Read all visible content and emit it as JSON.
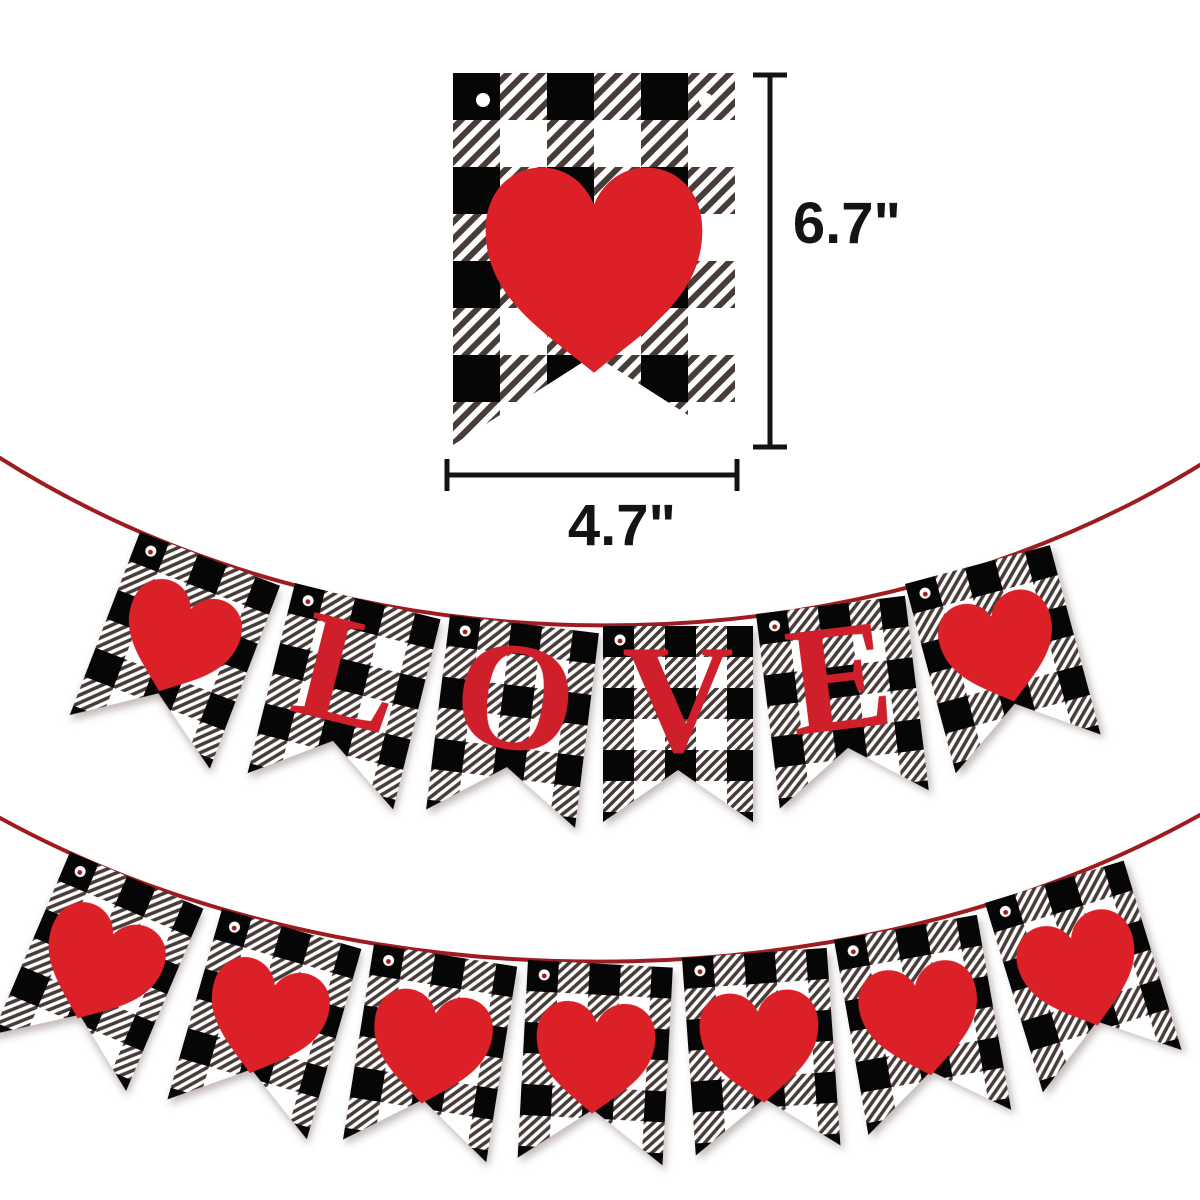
{
  "dimensions": {
    "height_label": "6.7\"",
    "width_label": "4.7\""
  },
  "reference_pennant": {
    "pattern": "buffalo-plaid",
    "hole_count": 2,
    "decoration": "heart"
  },
  "love_banner": {
    "word": "LOVE",
    "pennants": [
      {
        "type": "heart"
      },
      {
        "type": "letter",
        "letter": "L"
      },
      {
        "type": "letter",
        "letter": "O"
      },
      {
        "type": "letter",
        "letter": "V"
      },
      {
        "type": "letter",
        "letter": "E"
      },
      {
        "type": "heart"
      }
    ]
  },
  "hearts_banner": {
    "pennant_count": 7,
    "pennants": [
      {
        "type": "heart"
      },
      {
        "type": "heart"
      },
      {
        "type": "heart"
      },
      {
        "type": "heart"
      },
      {
        "type": "heart"
      },
      {
        "type": "heart"
      },
      {
        "type": "heart"
      }
    ]
  },
  "colors": {
    "heart_red": "#dc2027",
    "letter_red": "#cf1f2b",
    "string_red": "#9e1c20",
    "plaid_black": "#060606",
    "plaid_stripe": "#473c38",
    "plaid_white": "#ffffff",
    "dimension_black": "#141414",
    "background": "#ffffff"
  }
}
